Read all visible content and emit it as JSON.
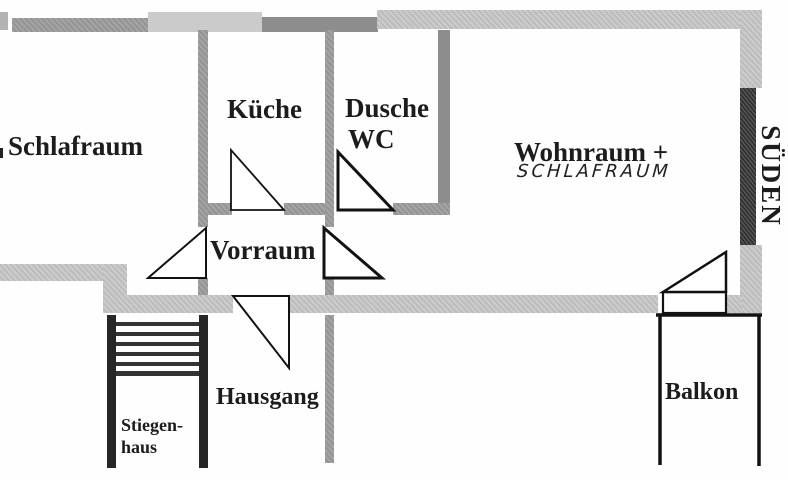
{
  "plan_type": "floor-plan",
  "rooms": {
    "schlafraum": {
      "label": "Schlafraum"
    },
    "kueche": {
      "label": "Küche"
    },
    "dusche_wc": {
      "line1": "Dusche",
      "line2": "WC"
    },
    "wohnraum": {
      "label": "Wohnraum +",
      "handwritten_sublabel": "SCHLAFRAUM"
    },
    "vorraum": {
      "label": "Vorraum"
    },
    "hausgang": {
      "label": "Hausgang"
    },
    "stiegenhaus": {
      "line1": "Stiegen-",
      "line2": "haus"
    },
    "balkon": {
      "label": "Balkon"
    }
  },
  "compass": {
    "south_label": "SÜDEN"
  },
  "stairs": {
    "step_count": 6
  },
  "colors": {
    "wall_light_gray": "#c6c6c6",
    "wall_medium_gray": "#9c9c9c",
    "wall_dark_gray": "#8d8d8d",
    "wall_near_black": "#3b3b3b",
    "line_black": "#121212",
    "text": "#1c1c1c",
    "background": "#fefefe"
  }
}
